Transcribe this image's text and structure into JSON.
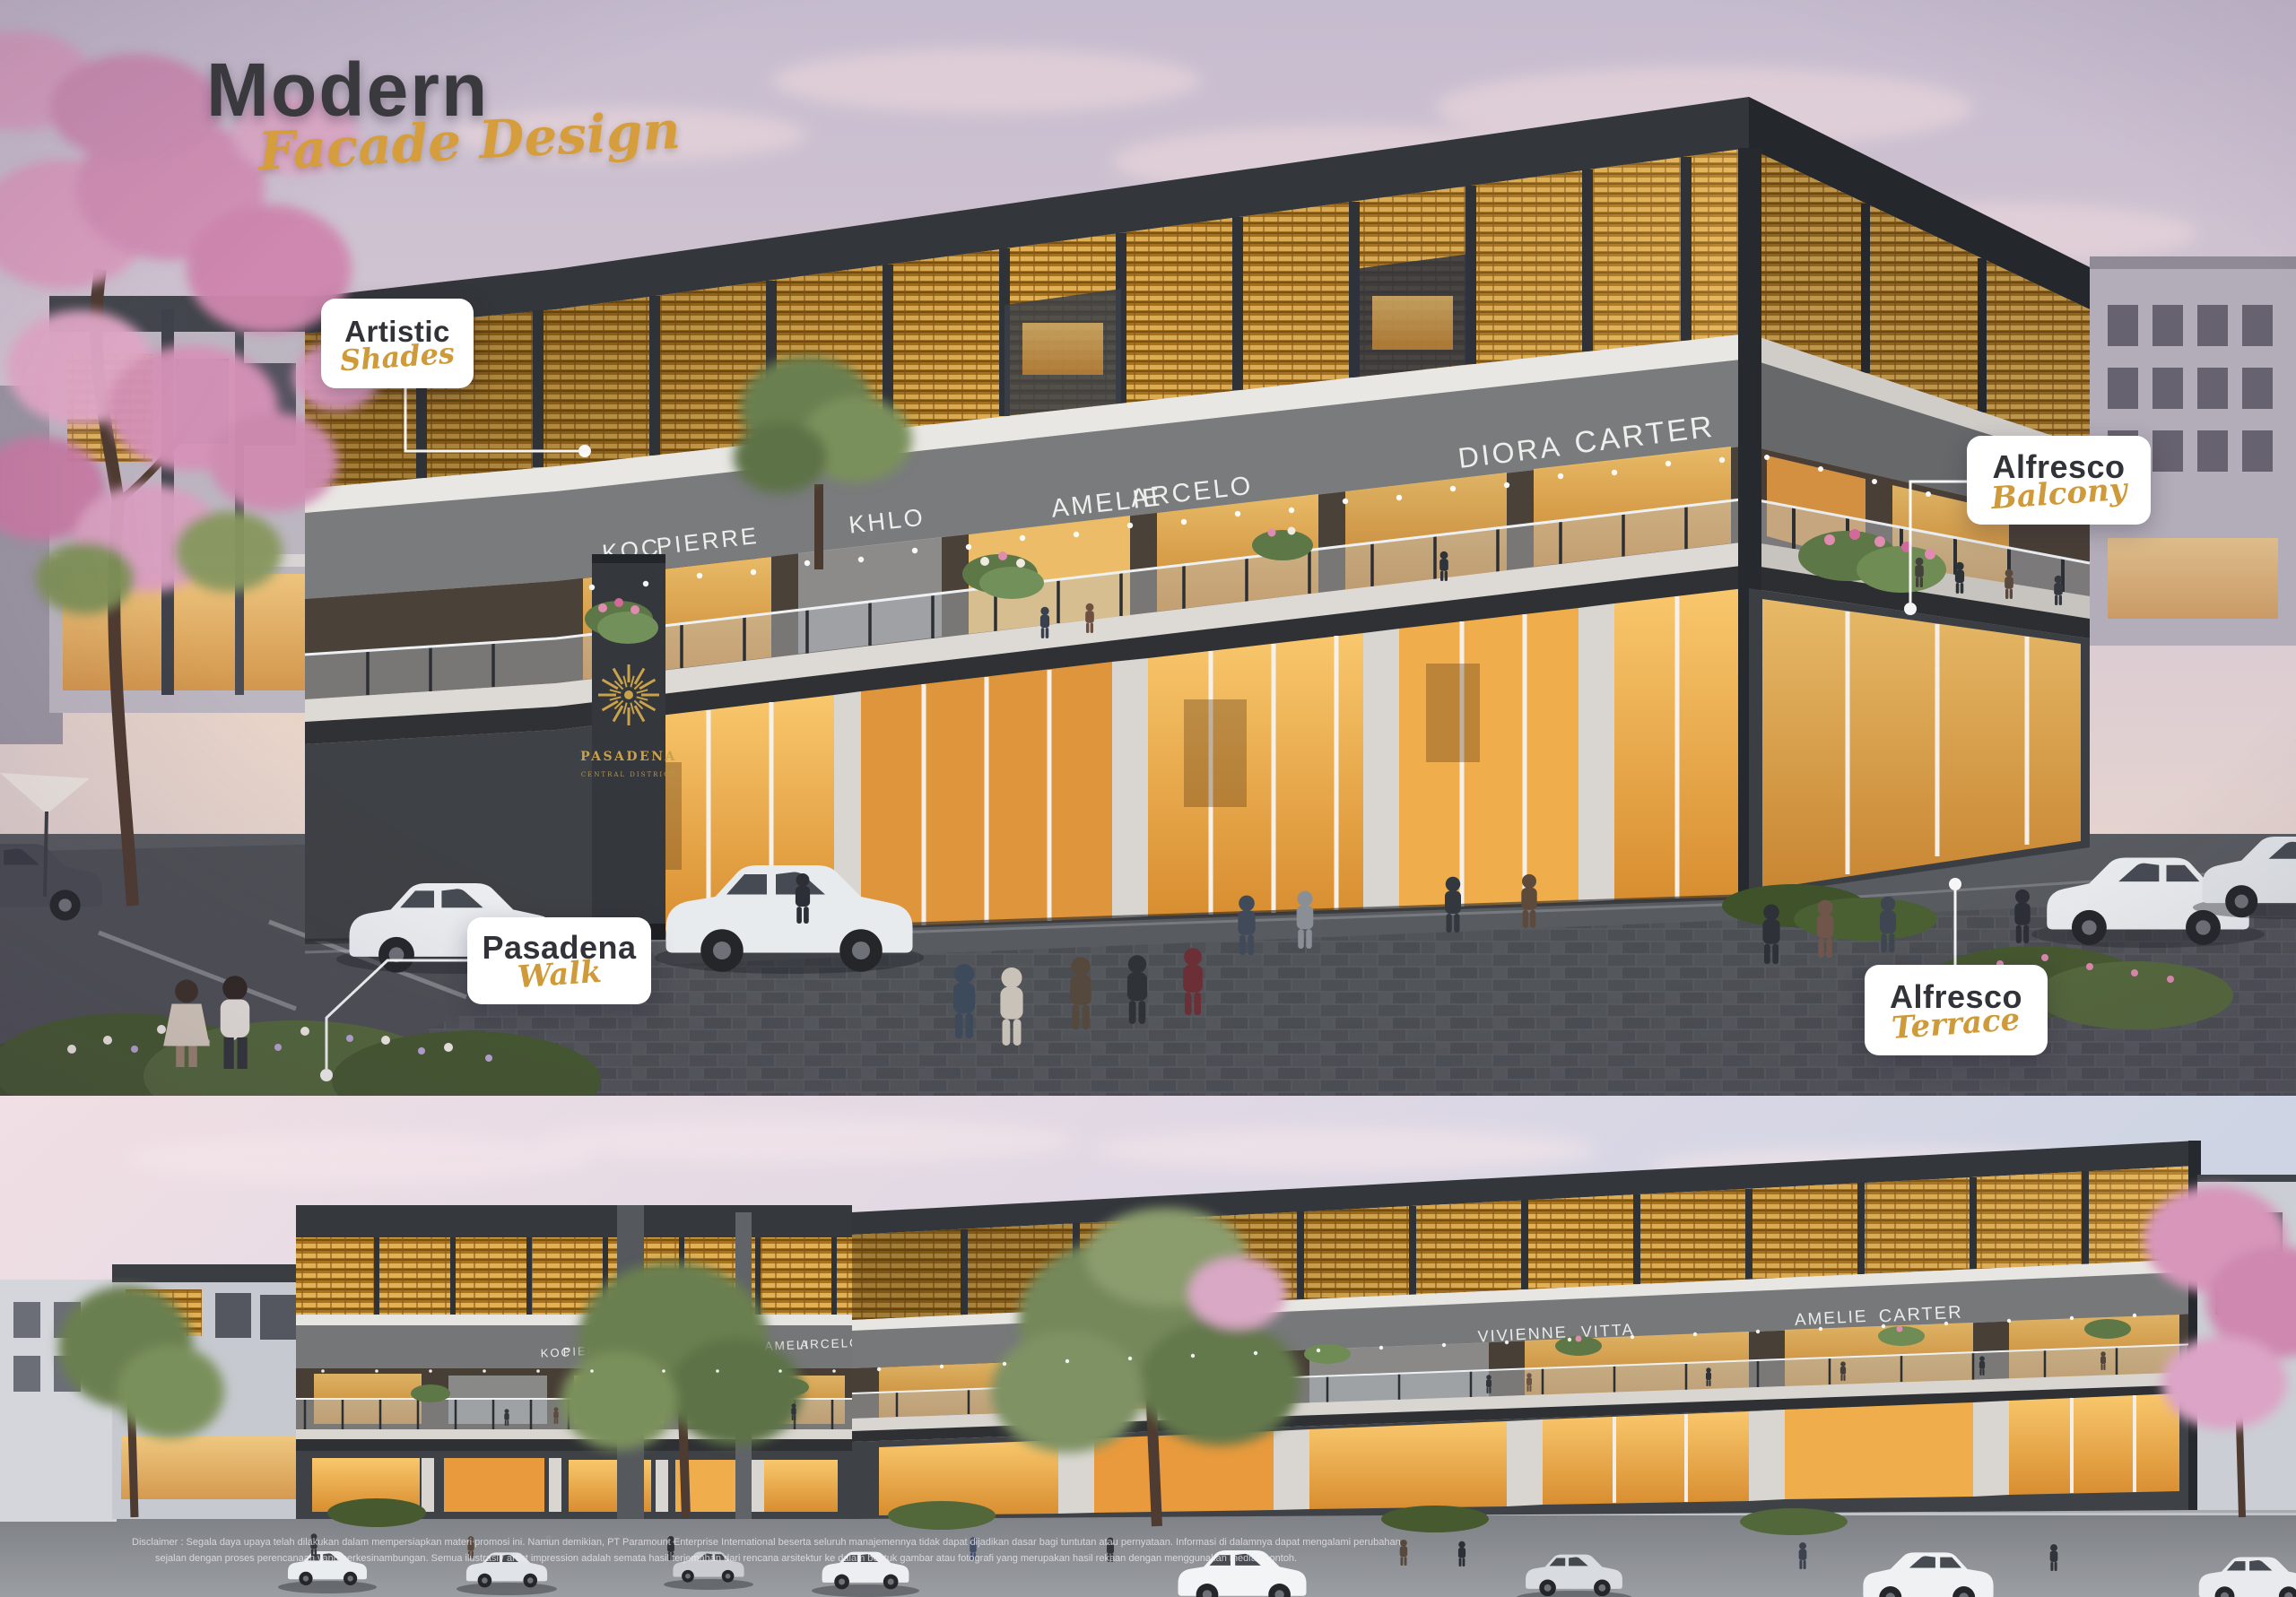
{
  "title": {
    "main": "Modern",
    "script": "Facade Design"
  },
  "callouts": [
    {
      "label": "Artistic",
      "script": "Shades"
    },
    {
      "label": "Alfresco",
      "script": "Balcony"
    },
    {
      "label": "Pasadena",
      "script": "Walk"
    },
    {
      "label": "Alfresco",
      "script": "Terrace"
    }
  ],
  "pylon": {
    "brand": "PASADENA",
    "sub": "CENTRAL DISTRICT"
  },
  "signage": {
    "top": [
      "KOC",
      "PIERRE",
      "KHLO",
      "AMELIE",
      "ARCELO",
      "DIORA",
      "CARTER"
    ],
    "bottom": [
      "KOC",
      "PIERRE",
      "KHLO",
      "AMELI",
      "ARCELO",
      "VIVIENNE",
      "VITTA",
      "AMELIE",
      "CARTER"
    ]
  },
  "disclaimer": {
    "line1": "Disclaimer : Segala daya upaya telah dilakukan dalam mempersiapkan materi promosi ini. Namun demikian, PT Paramount Enterprise International beserta seluruh manajemennya tidak dapat dijadikan dasar bagi tuntutan atau pernyataan. Informasi di dalamnya dapat mengalami perubahan",
    "line2": "sejalan dengan proses perencanaan yang berkesinambungan. Semua ilustrasi / artist impression adalah semata hasil terjemahan dari rencana arsitektur ke dalam bentuk gambar atau fotografi yang merupakan hasil rekaan dengan menggunakan media / contoh."
  },
  "colors": {
    "gold": "#D2A03E",
    "charcoal": "#36383D",
    "lattice": "#C9952F",
    "sky_top": "#C8BED2",
    "callout_text": "#323338"
  }
}
